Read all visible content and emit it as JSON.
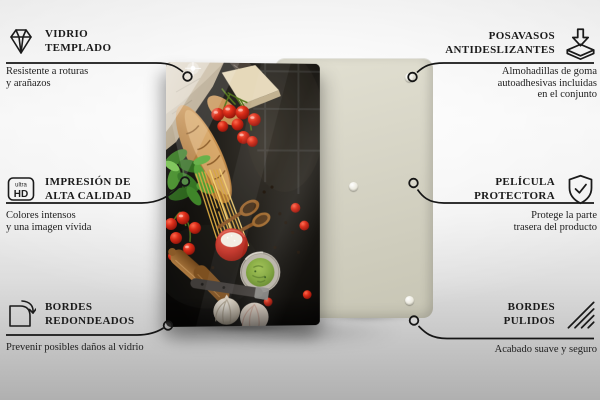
{
  "features_left": [
    {
      "icon": "diamond-icon",
      "title": "VIDRIO\nTEMPLADO",
      "description": "Resistente a roturas\ny arañazos"
    },
    {
      "icon": "ultra-hd-icon",
      "icon_text_top": "ultra",
      "icon_text_bottom": "HD",
      "title": "IMPRESIÓN DE\nALTA CALIDAD",
      "description": "Colores intensos\ny una imagen vívida"
    },
    {
      "icon": "rounded-corner-icon",
      "title": "BORDES\nREDONDEADOS",
      "description": "Prevenir posibles daños al vidrio"
    }
  ],
  "features_right": [
    {
      "icon": "coaster-arrow-icon",
      "title": "POSAVASOS\nANTIDESLIZANTES",
      "description": "Almohadillas de goma\nautoadhesivas incluidas\nen el conjunto"
    },
    {
      "icon": "shield-check-icon",
      "title": "PELÍCULA\nPROTECTORA",
      "description": "Protege la parte\ntrasera del producto"
    },
    {
      "icon": "polished-edge-icon",
      "title": "BORDES\nPULIDOS",
      "description": "Acabado suave y seguro"
    }
  ],
  "colors": {
    "connector_line": "#161616",
    "text": "#1b1b1b",
    "back_panel_beige": "#d6d4c5",
    "tomato_red": "#c92f1d",
    "pesto_green": "#7da339",
    "background_top": "#f1f1f1",
    "background_bottom": "#b0b0b0"
  }
}
